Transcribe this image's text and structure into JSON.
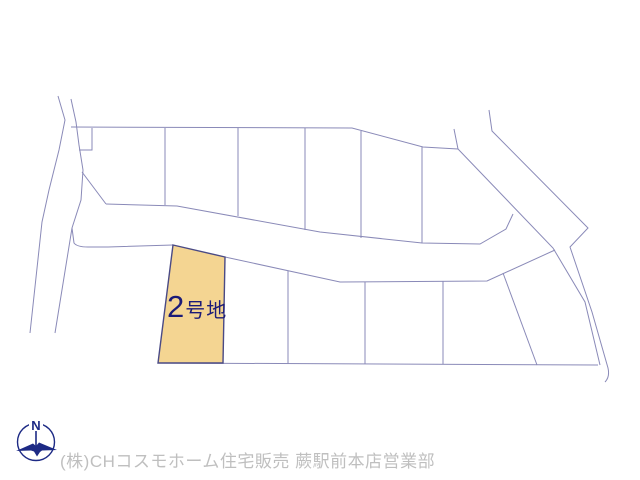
{
  "map": {
    "background": "#ffffff",
    "line_color": "#8a8ab8",
    "highlight_plot": {
      "label_number": "2",
      "label_suffix": "号地",
      "label_color": "#1b1b78",
      "fill": "#f4d592",
      "border": "#4a4a85",
      "points": "173,245 225,257 223,363 158,363"
    },
    "lines": [
      {
        "name": "left-road-outer-line",
        "d": "M58,96 L65,120 L59,150 L49,190 L42,222 L30,333"
      },
      {
        "name": "left-road-inner-line",
        "d": "M71,99 L76,122 L79,145 L83,170 L81,200 L72,228 L55,333"
      },
      {
        "name": "left-road-branch",
        "d": "M72,228 L74,243 Q77,247 88,247 L108,247 L173,245"
      },
      {
        "name": "upper-block-top-boundary",
        "d": "M71,127 L352,128 L423,147 L458,149"
      },
      {
        "name": "upper-block-notch",
        "d": "M92,128 L92,150 L79,150"
      },
      {
        "name": "upper-block-left-diagonal",
        "d": "M82,172 L106,204"
      },
      {
        "name": "middle-road-top-edge",
        "d": "M106,204 L177,206 L320,232 L422,243 L480,244 L506,229 L513,214"
      },
      {
        "name": "upper-divider-1",
        "d": "M165,128 L165,205"
      },
      {
        "name": "upper-divider-2",
        "d": "M238,128 L238,216"
      },
      {
        "name": "upper-divider-3",
        "d": "M305,128 L305,230"
      },
      {
        "name": "upper-divider-4",
        "d": "M361,131 L361,238"
      },
      {
        "name": "upper-divider-5",
        "d": "M422,147 L422,243"
      },
      {
        "name": "lower-block-top-boundary",
        "d": "M225,257 L340,282 L487,281 L555,250"
      },
      {
        "name": "lower-block-bottom-boundary",
        "d": "M158,363 L598,365"
      },
      {
        "name": "lower-divider-1",
        "d": "M288,271 L288,364"
      },
      {
        "name": "lower-divider-2",
        "d": "M365,282 L365,364"
      },
      {
        "name": "lower-divider-3",
        "d": "M443,281 L443,364"
      },
      {
        "name": "lower-divider-diagonal",
        "d": "M503,273 L537,365"
      },
      {
        "name": "right-road-left-edge",
        "d": "M454,129 L458,149 L553,248 L585,302 L600,365"
      },
      {
        "name": "right-road-right-edge",
        "d": "M489,110 L492,131 L588,228 L570,247 L592,312 L608,368 Q610,377 605,382"
      }
    ]
  },
  "compass": {
    "label": "N",
    "color": "#1d2a85"
  },
  "footer": {
    "text": "(株)CHコスモホーム住宅販売 蕨駅前本店営業部",
    "color": "#bfbfbf"
  }
}
